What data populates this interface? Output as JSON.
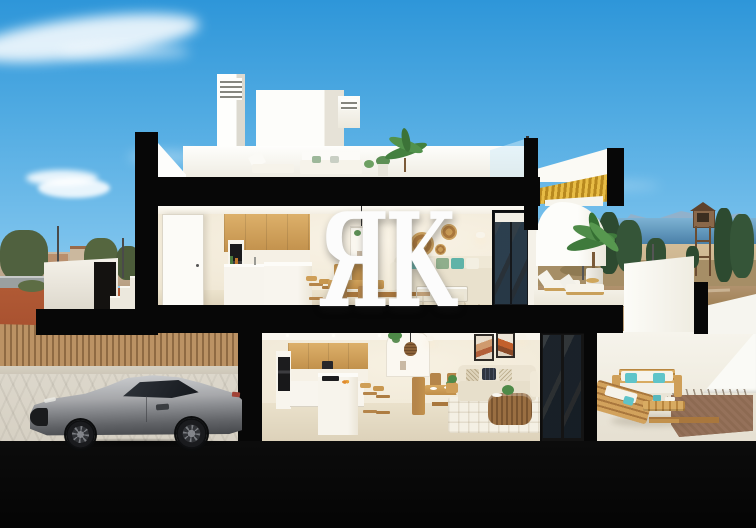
{
  "watermark": {
    "text": "ЯK"
  },
  "colors": {
    "sky-top": "#2e96d9",
    "sky-mid": "#79c1ec",
    "sky-low": "#bfe3f7",
    "cut-black": "#070707",
    "white-ext": "#f8f7f2",
    "wood": "#d2a25c",
    "wood-dark": "#a9773d",
    "teal": "#5fc4c9",
    "sofa-cream": "#e9e1cd",
    "gold": "#d9a92c",
    "car-silver": "#a7a8ab",
    "fence-wood": "#bb9264",
    "fence-dark": "#8f6a43",
    "sea": "#4a80a8",
    "sand": "#cdb691",
    "tree-dark": "#2d4a30",
    "gravel": "#8d6a52",
    "rattan": "#c89a55",
    "plant-green": "#4e8a48",
    "town-plaza": "#a8502f",
    "drive": "#d6d0c3",
    "watermark": "#fcfcfc"
  },
  "scene": {
    "type": "3d-cutaway-render",
    "setting": "cross-section of a two-storey coastal home under a blue sky",
    "objects": [
      "rooftop terrace with louvered chimneys, lounge furniture and palm",
      "upper-floor kitchen with oak cabinets, dining table and cream sofa",
      "upper terrace with curved white wall, palm pot and sun loungers",
      "ground-floor kitchen island, dining set, sofa and wall art",
      "driveway with silver sports coupe behind timber slat fence",
      "outdoor patio lounge set with teal cushions and gravel bed",
      "left background town skyline with trees and street lamps",
      "right background coastline with watchtower and cypress trees"
    ]
  }
}
